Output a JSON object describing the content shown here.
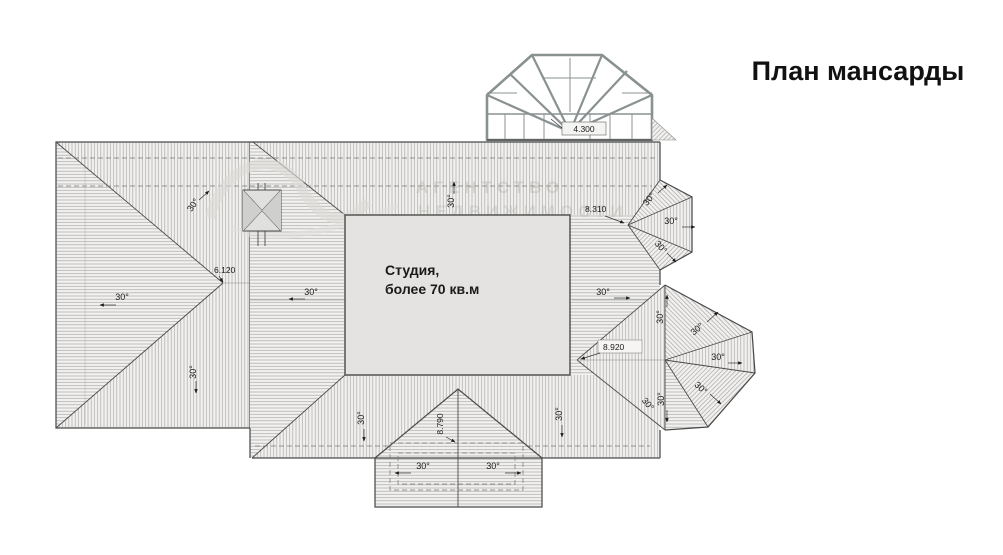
{
  "title": "План мансарды",
  "plan": {
    "room": {
      "line1": "Студия,",
      "line2": "более 70 кв.м"
    },
    "angle_label": "30°",
    "dimensions": {
      "dome_height": "4.300",
      "left_width": "6.120",
      "bay_top": "8.310",
      "bay_bottom": "8.920",
      "dormer": "8.790"
    }
  },
  "watermark": {
    "line1": "АГЕНТСТВО",
    "line2": "НЕДВИЖИМОСТИ"
  },
  "colors": {
    "line": "#4a4a4a",
    "hatch": "#a8a8a6",
    "studio_fill": "#e4e3e1",
    "dome_frame": "#8a9191",
    "watermark": "#b3b3ae"
  }
}
